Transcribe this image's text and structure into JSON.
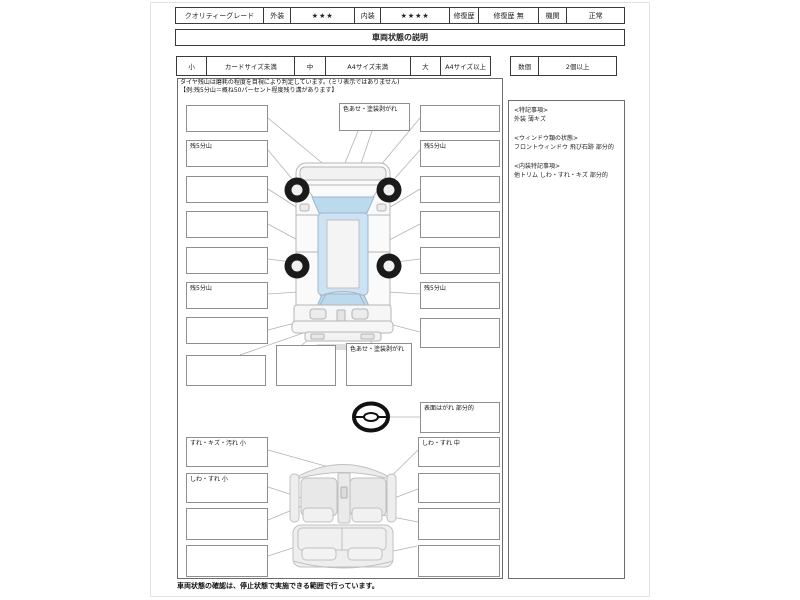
{
  "header": {
    "quality_grade": "クオリティーグレード",
    "exterior_label": "外装",
    "exterior_rating": "★★★",
    "interior_label": "内装",
    "interior_rating": "★★★★",
    "repair_history_label": "修復歴",
    "repair_history_value": "修復歴 無",
    "engine_label": "機関",
    "engine_value": "正常"
  },
  "title": "車両状態の説明",
  "legend": {
    "small": "小",
    "small_desc": "カードサイズ未満",
    "medium": "中",
    "medium_desc": "A4サイズ未満",
    "large": "大",
    "large_desc": "A4サイズ以上",
    "count": "数個",
    "count_desc": "2個以上"
  },
  "tire_note": {
    "line1": "タイヤ残山は磨耗の程度を目視により判定しています。(ミリ表示ではありません)",
    "line2": "【例:残5分山＝概ね50パーセント程度残り溝があります】"
  },
  "exterior": {
    "left_boxes": [
      "",
      "残5分山",
      "",
      "",
      "",
      "残5分山",
      ""
    ],
    "right_boxes": [
      "",
      "残5分山",
      "",
      "",
      "",
      "残5分山",
      ""
    ],
    "top_box": "色あせ・塗装剥がれ",
    "bottom_left_box": "",
    "bottom_mid_box": "",
    "bottom_paint_box": "色あせ・塗装剥がれ",
    "steering_box": "表面はがれ 部分的"
  },
  "interior": {
    "left_boxes": [
      "すれ・キズ・汚れ 小",
      "しわ・すれ 小",
      "",
      ""
    ],
    "right_boxes": [
      "しわ・すれ 中",
      "",
      "",
      ""
    ]
  },
  "notes_panel": {
    "sections": [
      {
        "title": "<特記事項>",
        "body": "外装 薄キズ"
      },
      {
        "title": "<ウィンドウ類の状態>",
        "body": "フロントウィンドウ 飛び石跡 部分的"
      },
      {
        "title": "<内装特記事項>",
        "body": "他トリム しわ・すれ・キズ 部分的"
      }
    ]
  },
  "footer": "車両状態の確認は、停止状態で実施できる範囲で行っています。",
  "colors": {
    "glass": "#cde2f3",
    "wheel": "#1a1a1a",
    "leader_line": "#b3b3b3"
  }
}
